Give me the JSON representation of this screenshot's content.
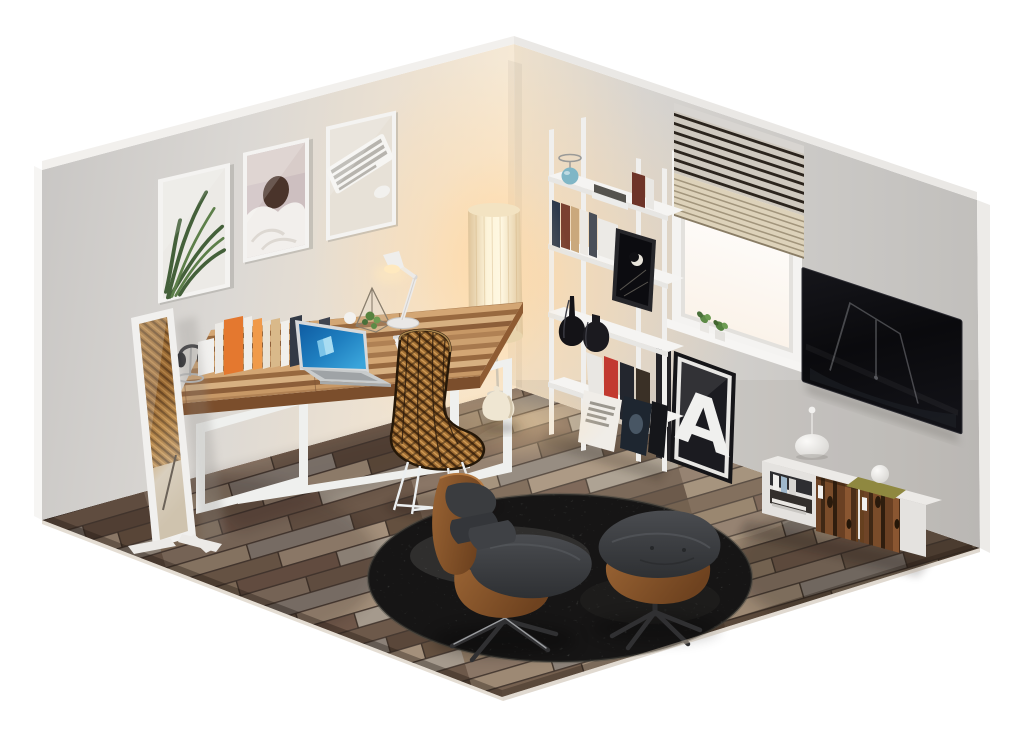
{
  "meta": {
    "description": "Isometric cutaway render of a home office room with desk, lounge chair, bookshelf, window and wall TV",
    "canvas": {
      "width": 1024,
      "height": 733
    }
  },
  "scene": {
    "background": "#ffffff",
    "poster": {
      "letter": "A",
      "letter_color": "#f0f0ee",
      "frame_color": "#151518"
    },
    "colors": {
      "left_wall": "#d8d5d1",
      "right_wall": "#cdcbc8",
      "corner_glow": "#f7e6c9",
      "floor_base": "#7b685a",
      "rug": "#6f6e6c",
      "desk_wood": "#b4845a",
      "desk_frame": "#eff0ee",
      "rattan": "#a06e33",
      "walnut": "#8a5a33",
      "leather": "#3b3d40",
      "accent_teal": "#7fb6c6",
      "accent_red": "#c23a30",
      "accent_orange": "#e4782f",
      "laptop_screen_blue": "#1f7fc0",
      "lamp_shade": "#fdf2d6",
      "tv_screen": "#0b0b0e",
      "door_wood": "#5e3a22",
      "tray_olive": "#8f8840"
    },
    "objects": [
      {
        "name": "wall-art-plant",
        "label": "framed plant photo"
      },
      {
        "name": "wall-art-bed",
        "label": "framed bed photo"
      },
      {
        "name": "wall-art-keyboard",
        "label": "framed keyboard photo"
      },
      {
        "name": "standing-mirror",
        "label": "leaning floor mirror"
      },
      {
        "name": "desk",
        "label": "wooden desk with white frame"
      },
      {
        "name": "laptop",
        "label": "open laptop, blue screen"
      },
      {
        "name": "desk-lamp",
        "label": "white articulated desk lamp"
      },
      {
        "name": "headphones",
        "label": "headphones on stand"
      },
      {
        "name": "desk-books",
        "label": "row of books and folders"
      },
      {
        "name": "terrarium",
        "label": "geometric glass terrarium"
      },
      {
        "name": "rattan-chair",
        "label": "rattan desk chair"
      },
      {
        "name": "floor-lamp",
        "label": "glowing cylinder floor lamp"
      },
      {
        "name": "ladder-shelf",
        "label": "white ladder bookshelf"
      },
      {
        "name": "shelf-lamp-teal",
        "label": "teal glass accent lamp"
      },
      {
        "name": "black-vases",
        "label": "two black vases"
      },
      {
        "name": "poster-a",
        "label": "leaning letter poster"
      },
      {
        "name": "window",
        "label": "window with blinds"
      },
      {
        "name": "windowsill-plants",
        "label": "two small plants"
      },
      {
        "name": "tv",
        "label": "wall mounted TV"
      },
      {
        "name": "tv-stand",
        "label": "white media stand with wood doors"
      },
      {
        "name": "round-rug",
        "label": "round shaggy gray rug"
      },
      {
        "name": "lounge-chair",
        "label": "walnut lounge chair"
      },
      {
        "name": "ottoman",
        "label": "lounge ottoman"
      }
    ]
  }
}
